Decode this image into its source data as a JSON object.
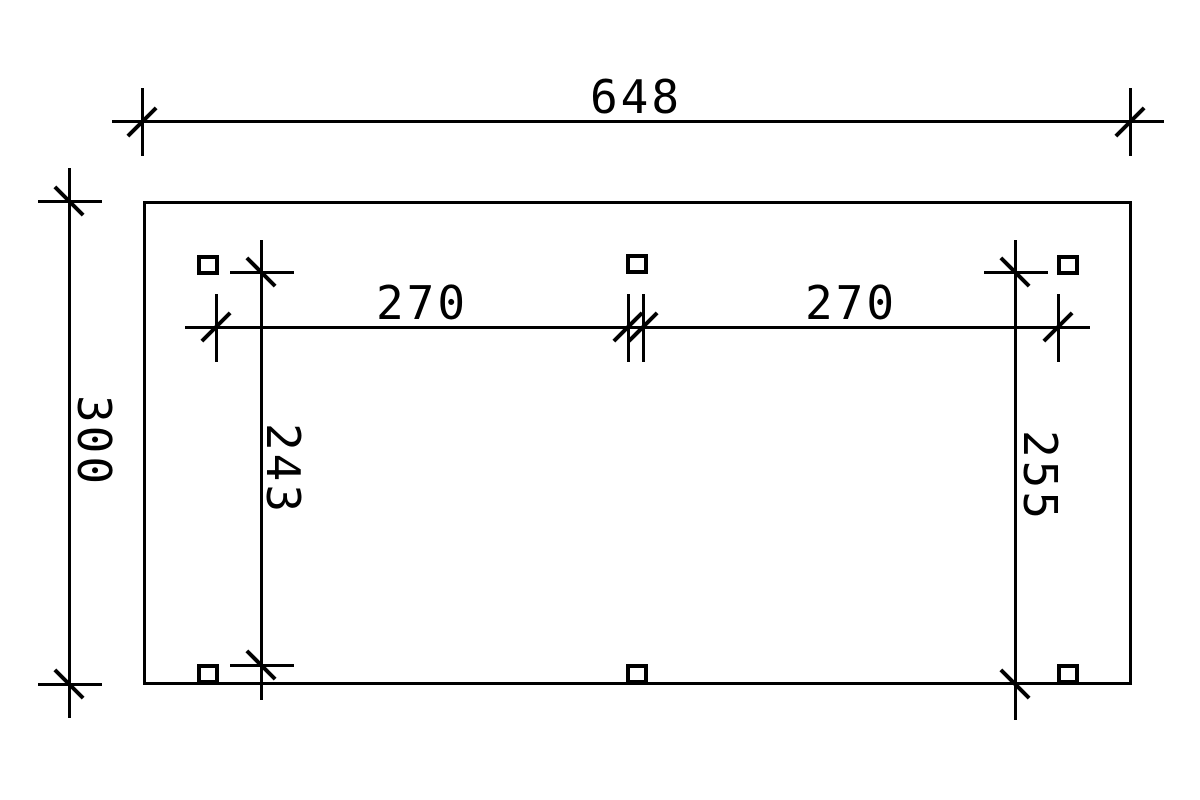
{
  "colors": {
    "ink": "#000000",
    "paper": "#ffffff"
  },
  "dim_labels": {
    "overall_width": "648",
    "overall_depth": "300",
    "left_bay_width": "270",
    "right_bay_width": "270",
    "left_post_offset": "243",
    "right_post_offset": "255"
  }
}
